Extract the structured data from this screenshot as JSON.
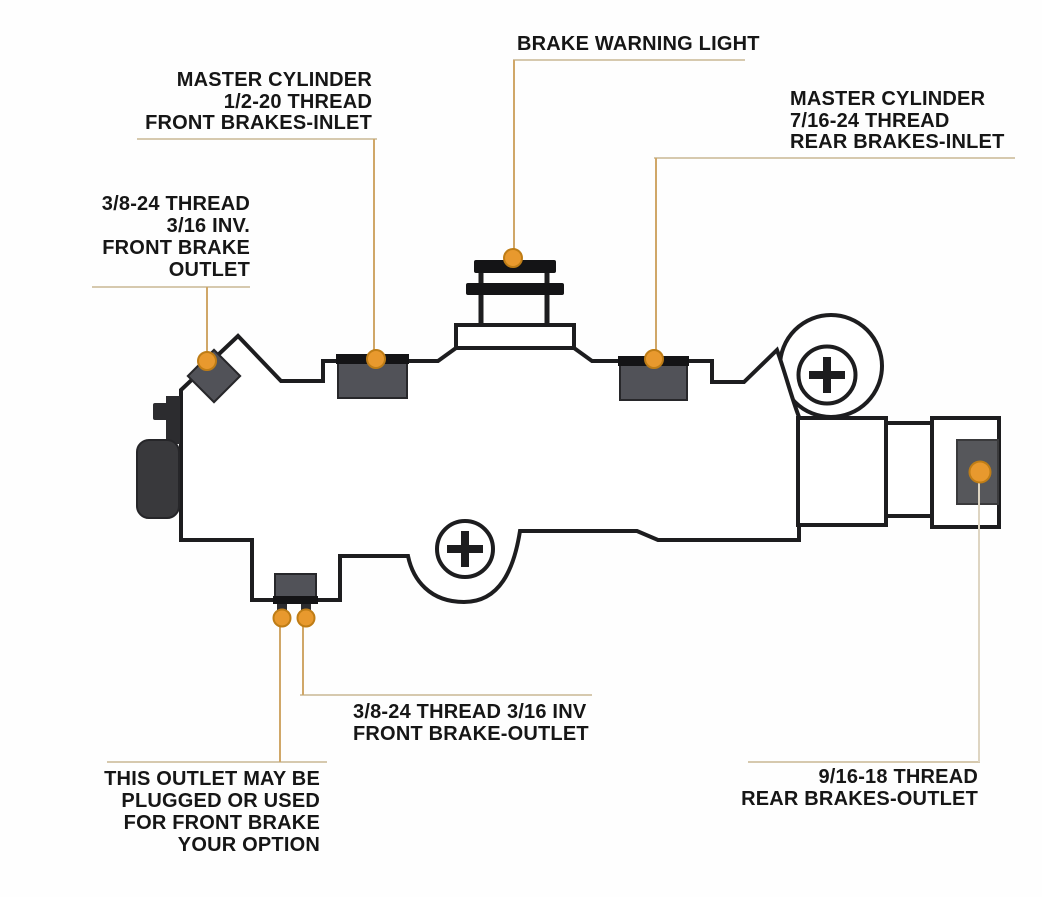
{
  "title": "Combination brake valve port identification diagram",
  "labels": {
    "brake_warning_light": {
      "lines": [
        "BRAKE WARNING LIGHT"
      ]
    },
    "master_cylinder_front": {
      "lines": [
        "MASTER CYLINDER",
        "1/2-20 THREAD",
        "FRONT BRAKES-INLET"
      ]
    },
    "master_cylinder_rear": {
      "lines": [
        "MASTER CYLINDER",
        "7/16-24 THREAD",
        "REAR BRAKES-INLET"
      ]
    },
    "front_brake_outlet_left": {
      "lines": [
        "3/8-24 THREAD",
        "3/16 INV.",
        "FRONT BRAKE",
        "OUTLET"
      ]
    },
    "front_brake_outlet_bottom": {
      "lines": [
        "3/8-24 THREAD 3/16 INV",
        "FRONT BRAKE-OUTLET"
      ]
    },
    "optional_outlet": {
      "lines": [
        "THIS OUTLET MAY BE",
        "PLUGGED OR USED",
        "FOR FRONT BRAKE",
        "YOUR OPTION"
      ]
    },
    "rear_brakes_outlet": {
      "lines": [
        "9/16-18 THREAD",
        "REAR BRAKES-OUTLET"
      ]
    }
  },
  "port_markers": [
    "front-brake-outlet-diagonal-port",
    "front-brakes-inlet-port",
    "brake-warning-light-switch",
    "rear-brakes-inlet-port",
    "front-brake-outlet-bottom-port",
    "optional-front-brake-outlet-port",
    "rear-brakes-outlet-port"
  ],
  "colors": {
    "outline": "#1d1d1f",
    "body_fill": "#ffffff",
    "port_fill": "#515258",
    "port_border": "#27272a",
    "cap_fill": "#141416",
    "accent_orange": "#e8992e",
    "accent_orange_border": "#bf7d16",
    "leader_line": "#d6c9ae",
    "leader_vertical": "#d0a768",
    "leader_light": "#ded5c2",
    "text_color": "#161616",
    "dark_part": "#39393c",
    "inset_fill": "#56575b",
    "bg": "#fefefe"
  }
}
